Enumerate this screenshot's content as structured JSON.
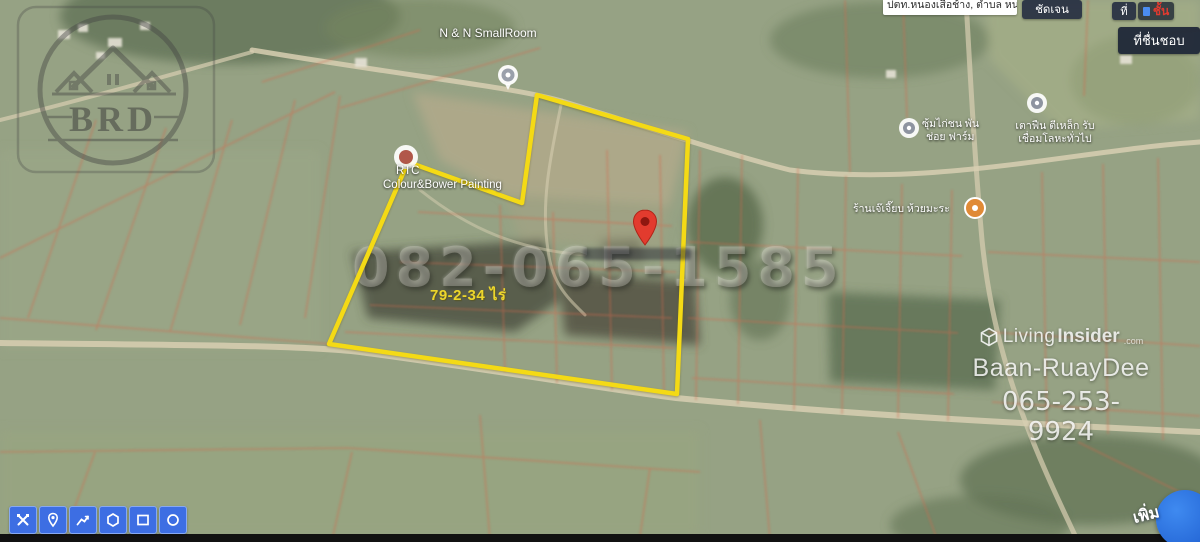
{
  "header": {
    "location_text": "ปตท.หนองเสือช้าง, ตำบล หนองเสือช้าง อำเภอ",
    "clear_button": "ชัดเจน",
    "pin_button": "ที่",
    "layers_button": "ชั้น",
    "favorites_button": "ที่ชื่นชอบ"
  },
  "map": {
    "area_label": "79-2-34 ไร่",
    "phone_watermark": "082-065-1585",
    "poi": [
      {
        "name": "N & N SmallRoom"
      },
      {
        "line1": "RTC",
        "line2": "Colour&Bower Painting"
      },
      {
        "line1": "ซุ้มไก่ชน พัน",
        "line2": "ช่อย ฟาร์ม"
      },
      {
        "line1": "เตาฟืน ตีเหล็ก รับ",
        "line2": "เชื่อมโลหะทั่วไป"
      },
      {
        "line1": "ร้านเจ๊เจี๊ยบ ห้วยมะระ"
      }
    ]
  },
  "branding": {
    "brd_logo_text": "BRD",
    "living_insider": {
      "brand_light": "Living",
      "brand_bold": "Insider",
      "domain_suffix": ".com",
      "agent_name": "Baan-RuayDee",
      "phone": "065-253-9924"
    }
  },
  "toolbar": {
    "icons": [
      "edit-tools-icon",
      "marker-icon",
      "polyline-icon",
      "polygon-icon",
      "rectangle-icon",
      "circle-icon"
    ]
  },
  "add_button_label": "เพิ่ม",
  "colors": {
    "boundary_yellow": "#f4da15",
    "pin_red": "#e23b2e",
    "tool_blue": "#3d6ee3",
    "area_text_yellow": "#ecd62b",
    "cadastral_orange": "#d4694d"
  }
}
